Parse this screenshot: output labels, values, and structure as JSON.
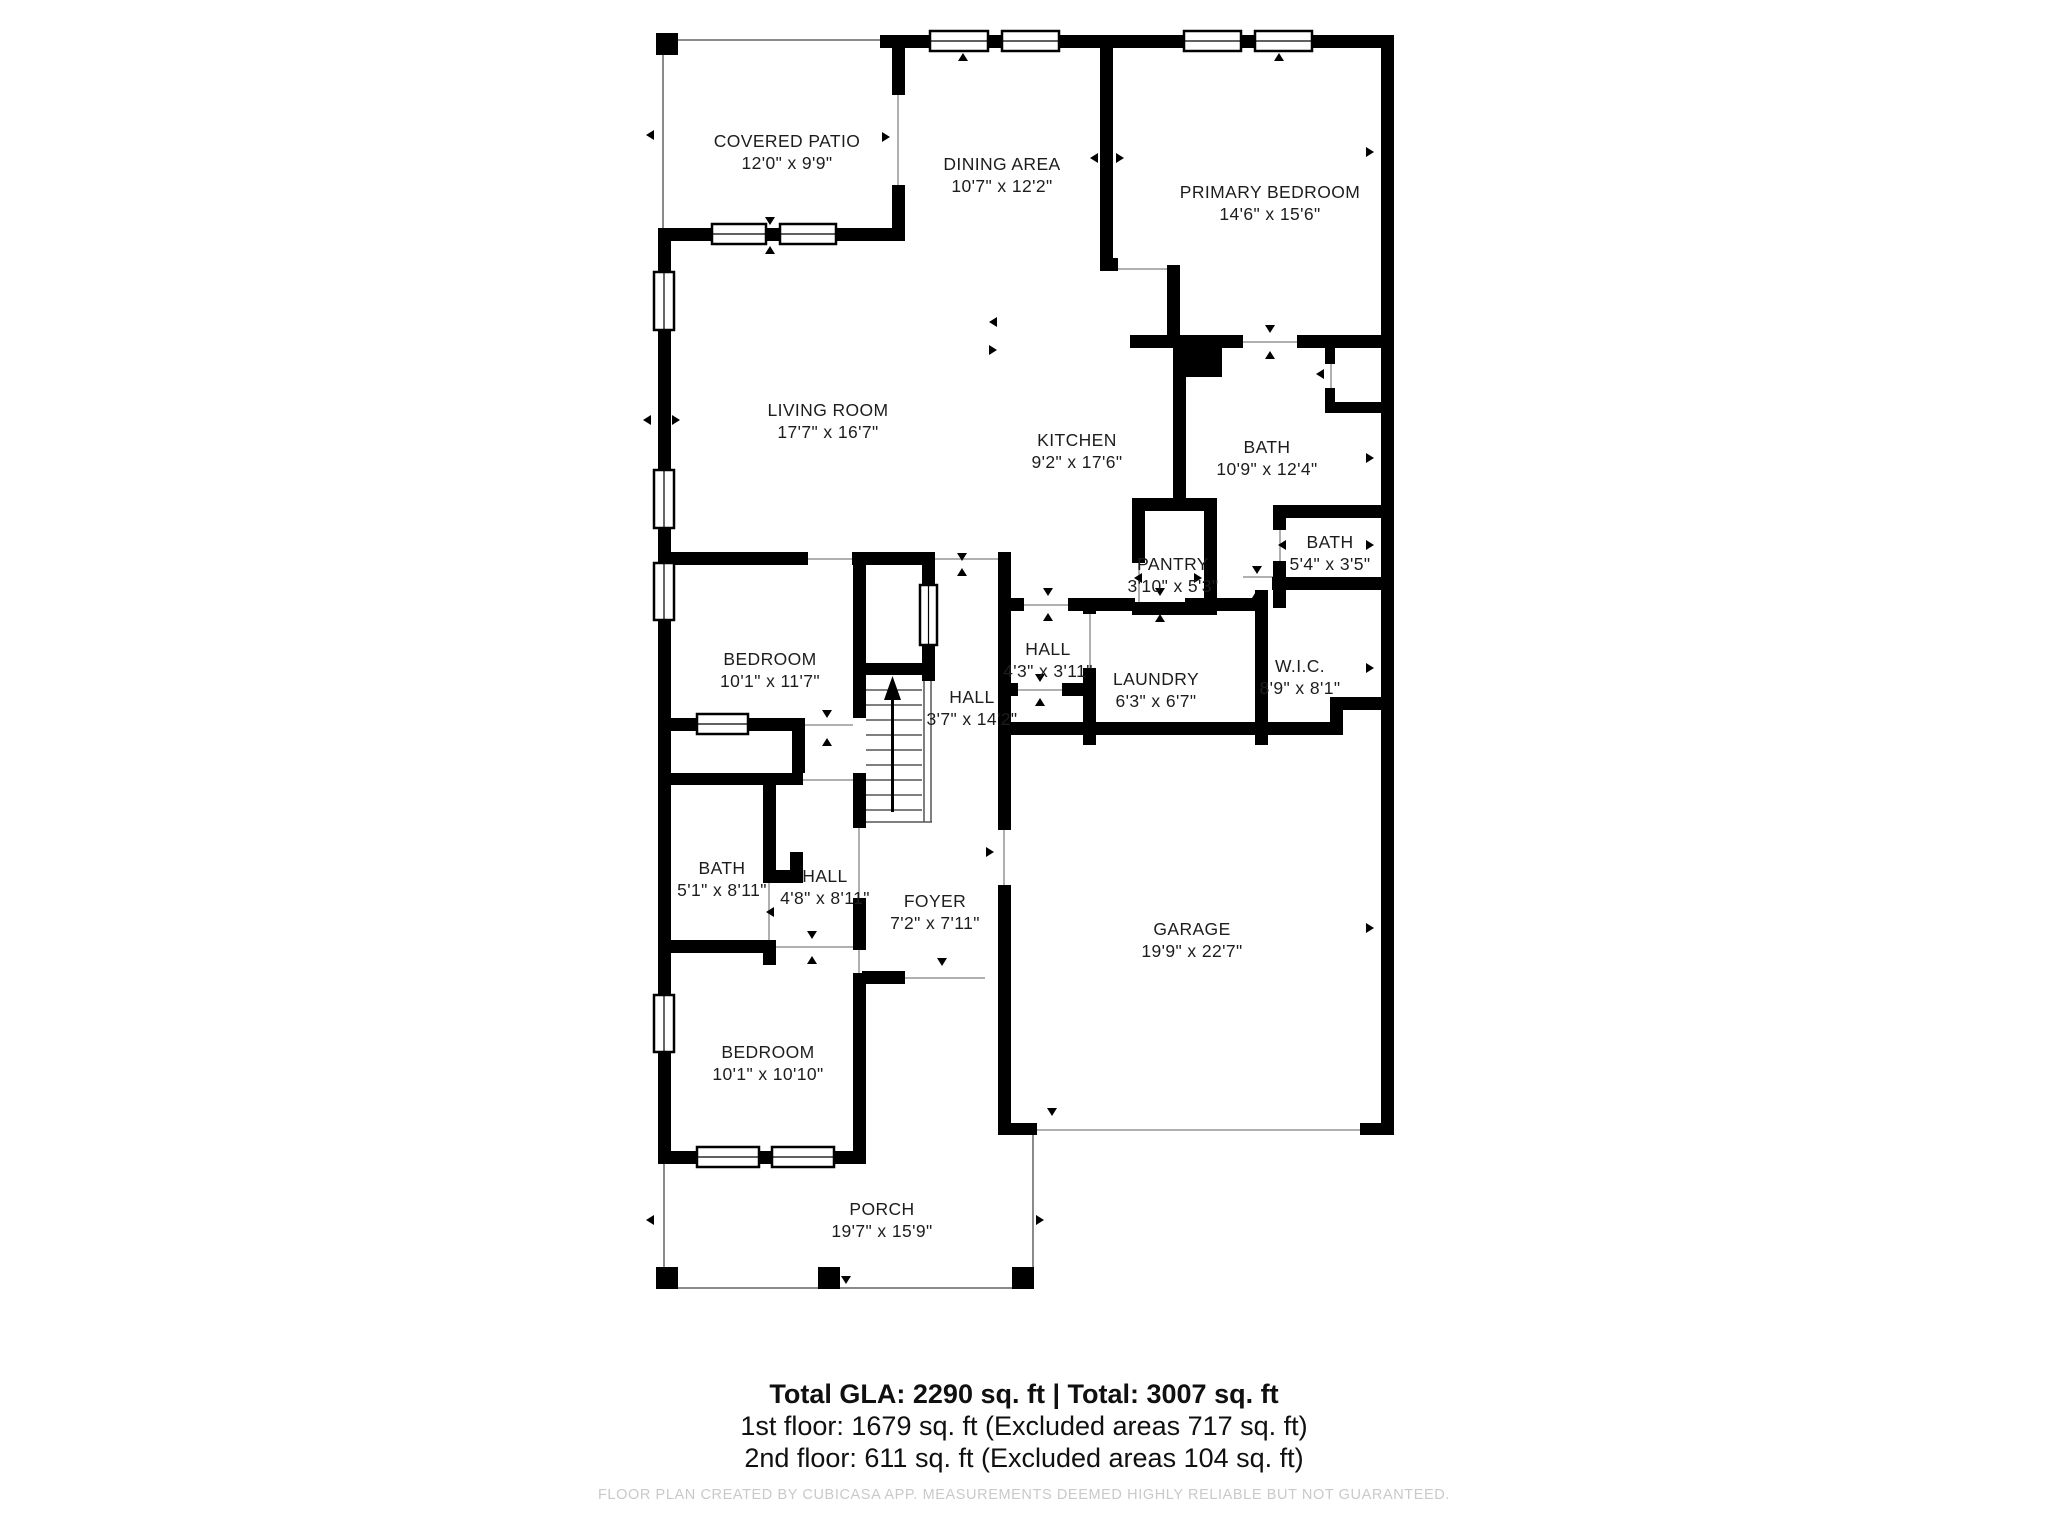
{
  "title": "Floor plan",
  "rooms": [
    {
      "id": "covered-patio",
      "name": "COVERED PATIO",
      "dims": "12'0\" x 9'9\""
    },
    {
      "id": "dining-area",
      "name": "DINING AREA",
      "dims": "10'7\" x 12'2\""
    },
    {
      "id": "primary-bedroom",
      "name": "PRIMARY BEDROOM",
      "dims": "14'6\" x 15'6\""
    },
    {
      "id": "living-room",
      "name": "LIVING ROOM",
      "dims": "17'7\" x 16'7\""
    },
    {
      "id": "kitchen",
      "name": "KITCHEN",
      "dims": "9'2\" x 17'6\""
    },
    {
      "id": "bath-primary",
      "name": "BATH",
      "dims": "10'9\" x 12'4\""
    },
    {
      "id": "pantry",
      "name": "PANTRY",
      "dims": "3'10\" x 5'3\""
    },
    {
      "id": "bath-upper",
      "name": "BATH",
      "dims": "5'4\" x 3'5\""
    },
    {
      "id": "hall-small",
      "name": "HALL",
      "dims": "4'3\" x 3'11\""
    },
    {
      "id": "laundry",
      "name": "LAUNDRY",
      "dims": "6'3\" x 6'7\""
    },
    {
      "id": "wic",
      "name": "W.I.C.",
      "dims": "8'9\" x 8'1\""
    },
    {
      "id": "hall-stairs",
      "name": "HALL",
      "dims": "3'7\" x 14'2\""
    },
    {
      "id": "bedroom-upper",
      "name": "BEDROOM",
      "dims": "10'1\" x 11'7\""
    },
    {
      "id": "bath-lower",
      "name": "BATH",
      "dims": "5'1\" x 8'11\""
    },
    {
      "id": "hall-lower",
      "name": "HALL",
      "dims": "4'8\" x 8'11\""
    },
    {
      "id": "foyer",
      "name": "FOYER",
      "dims": "7'2\" x 7'11\""
    },
    {
      "id": "garage",
      "name": "GARAGE",
      "dims": "19'9\" x 22'7\""
    },
    {
      "id": "bedroom-lower",
      "name": "BEDROOM",
      "dims": "10'1\" x 10'10\""
    },
    {
      "id": "porch",
      "name": "PORCH",
      "dims": "19'7\" x 15'9\""
    }
  ],
  "summary": {
    "total_line": "Total GLA: 2290 sq. ft | Total: 3007 sq. ft",
    "first_floor_line": "1st floor: 1679 sq. ft (Excluded areas 717 sq. ft)",
    "second_floor_line": "2nd floor: 611 sq. ft (Excluded areas 104 sq. ft)"
  },
  "disclaimer": "FLOOR PLAN CREATED BY CUBICASA APP. MEASUREMENTS DEEMED HIGHLY RELIABLE BUT NOT GUARANTEED.",
  "colors": {
    "wall": "#000000",
    "label_text": "#1d1d1f",
    "summary_text": "#101010",
    "disclaimer_text": "#c9c9c9",
    "thin_line": "#8a8a8a",
    "threshold_line": "#b0b0b0",
    "tread_line": "#555555"
  }
}
